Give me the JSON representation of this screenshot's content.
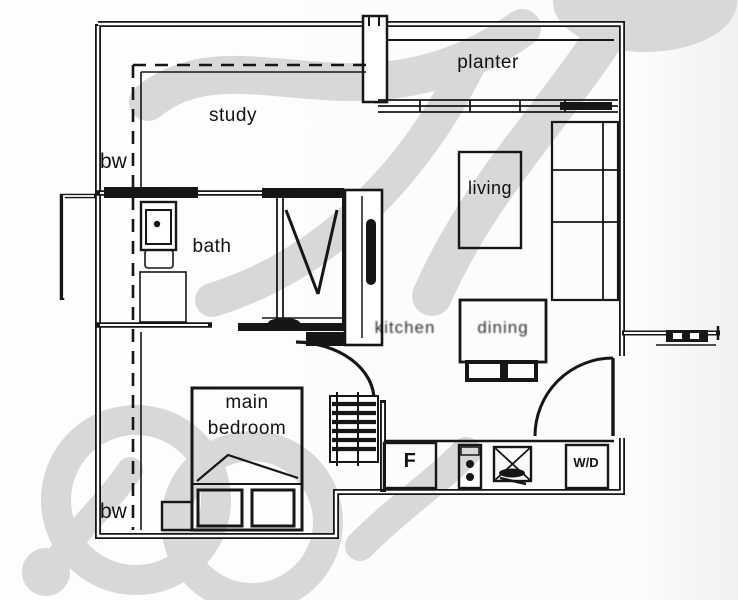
{
  "rooms": {
    "planter": "planter",
    "study": "study",
    "living": "living",
    "bath": "bath",
    "main_bedroom_line1": "main",
    "main_bedroom_line2": "bedroom",
    "kitchen": "kitchen",
    "dining": "dining"
  },
  "annotations": {
    "bw_top": "bw",
    "bw_bottom": "bw"
  },
  "appliances": {
    "fridge": "F",
    "washer_dryer": "W/D"
  },
  "colors": {
    "line": "#161616",
    "watermark": "#d8d8d8",
    "background": "#fcfcfc"
  }
}
